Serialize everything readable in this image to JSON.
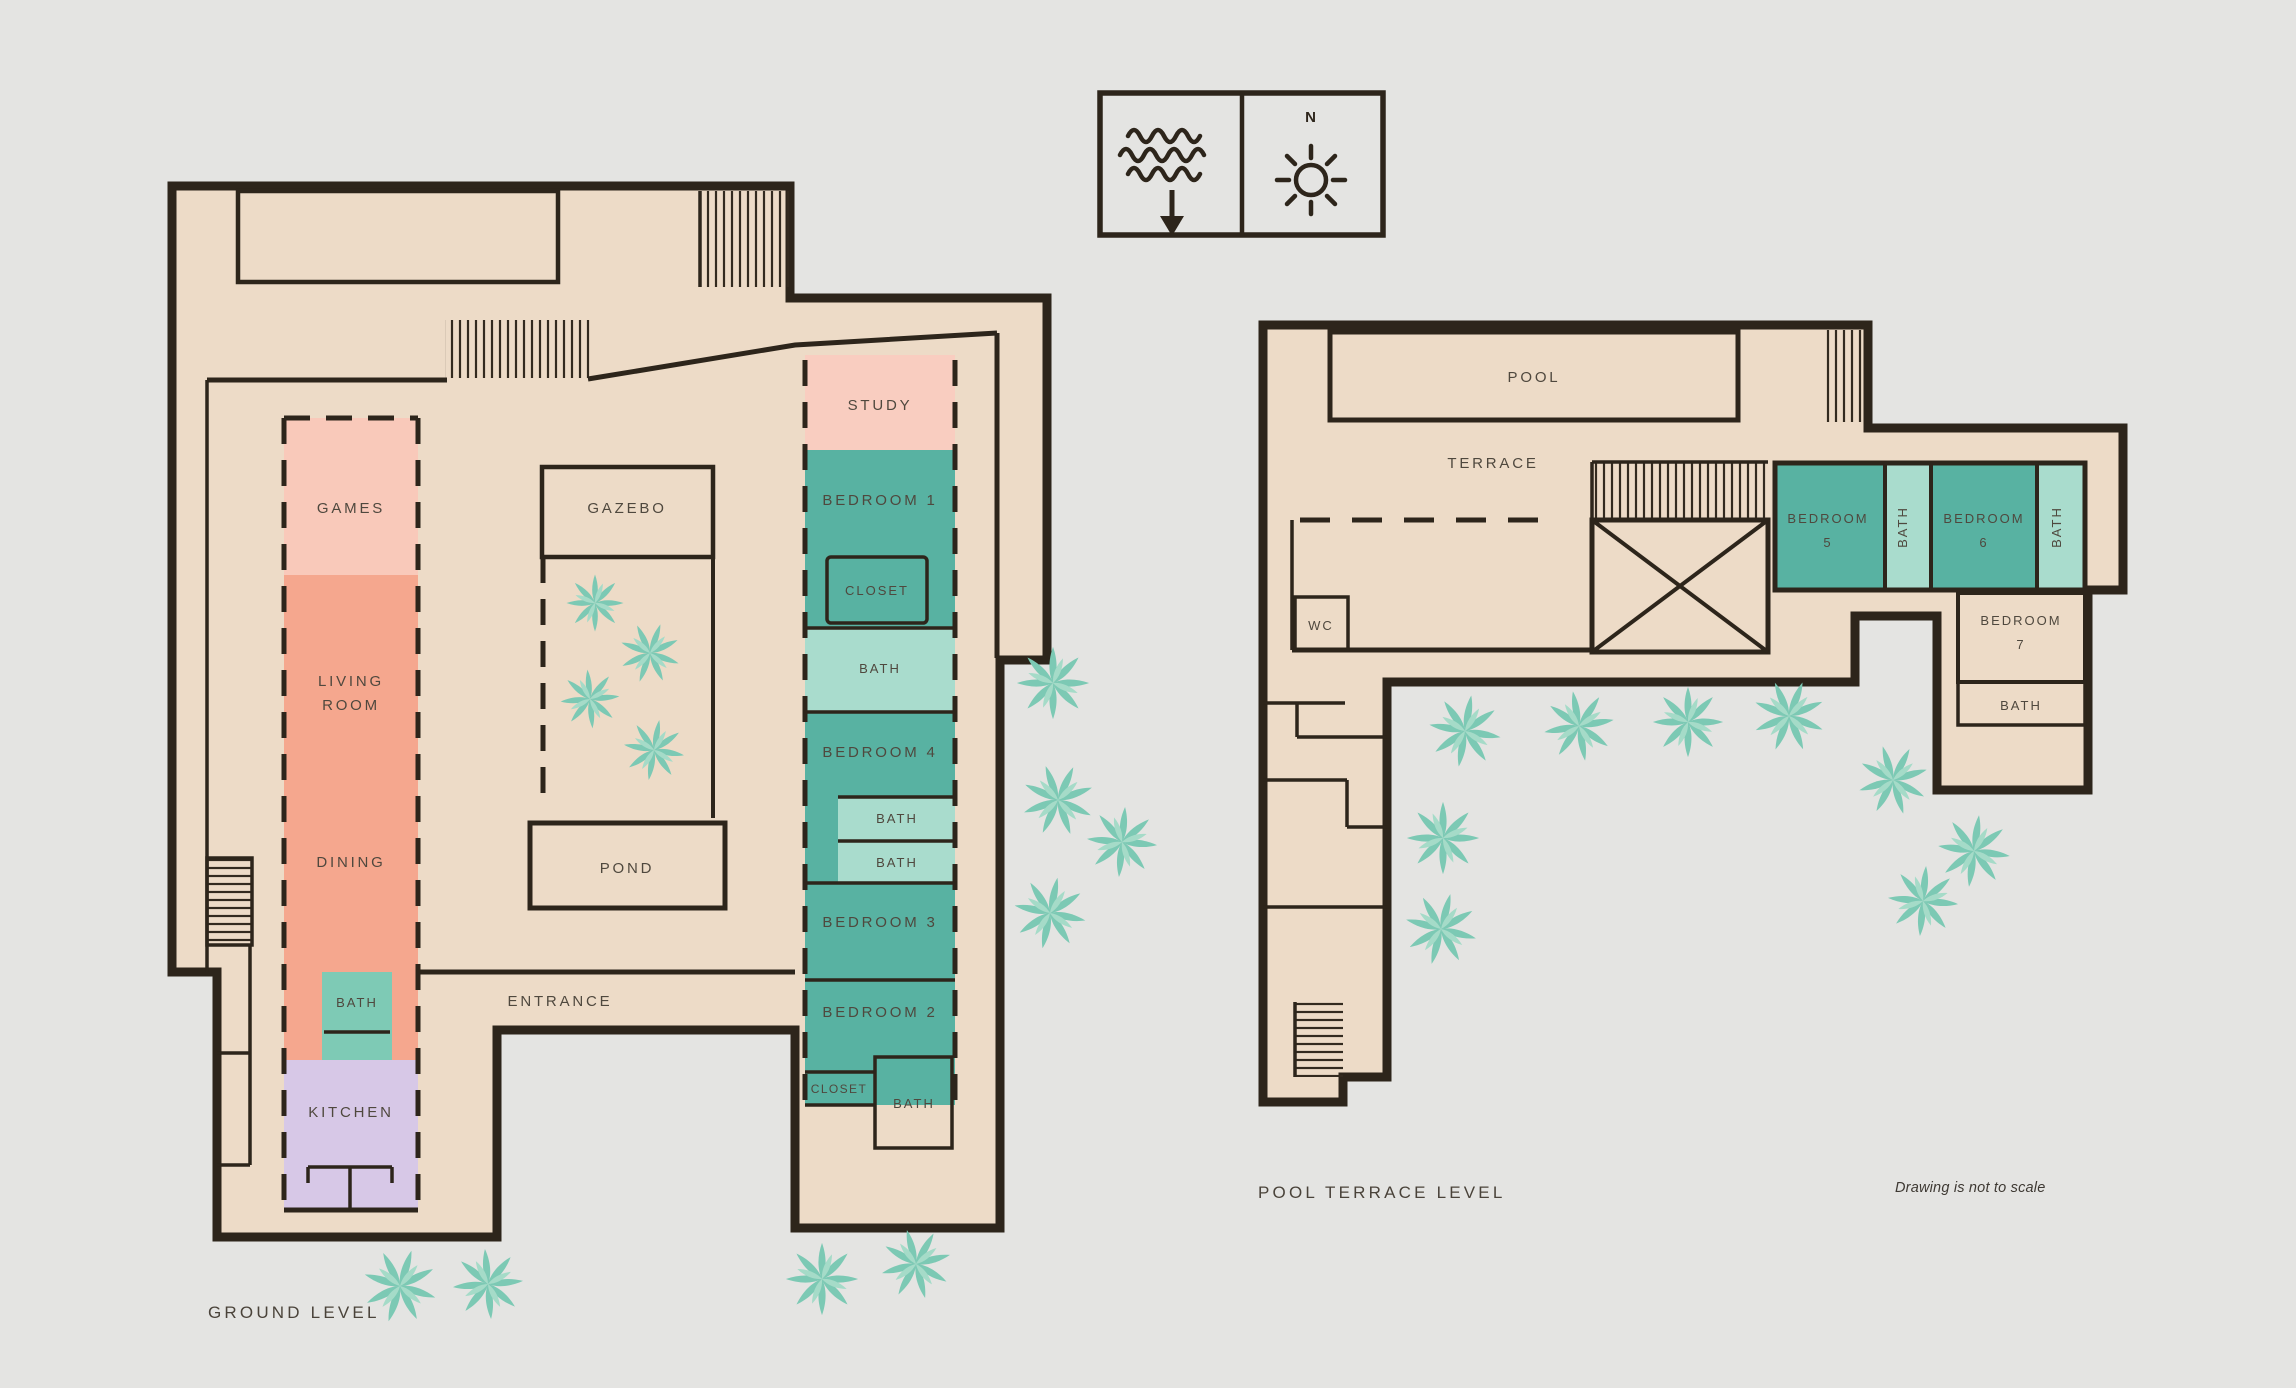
{
  "page": {
    "background": "#e4e4e2",
    "note": "Drawing is not to scale",
    "colors": {
      "floor": "#eddbc7",
      "wall": "#2d251b",
      "label_text": "#4f483e",
      "pink": "#f9c9ba",
      "salmon": "#f5a78e",
      "lavender": "#d7c8e7",
      "teal_bedroom": "#58b2a2",
      "teal_bath_medium": "#7ecab5",
      "teal_bath_light": "#a9dccd",
      "water_blue": "#97dadd",
      "plant": "#7cc9b4",
      "plant_light": "#a5dbc8"
    }
  },
  "legend": {
    "north_label": "N",
    "icons": {
      "waves": "waves-icon",
      "direction": "down-arrow-icon",
      "sun": "sun-icon"
    }
  },
  "ground_level": {
    "title": "GROUND LEVEL",
    "rooms": {
      "games": "GAMES",
      "living_room": [
        "LIVING",
        "ROOM"
      ],
      "dining": "DINING",
      "bath_main": "BATH",
      "kitchen": "KITCHEN",
      "gazebo": "GAZEBO",
      "pond": "POND",
      "entrance": "ENTRANCE",
      "study": "STUDY",
      "bedroom1": "BEDROOM 1",
      "closet1": "CLOSET",
      "bath1": "BATH",
      "bedroom4": "BEDROOM 4",
      "bath4a": "BATH",
      "bath4b": "BATH",
      "bedroom3": "BEDROOM 3",
      "bedroom2": "BEDROOM 2",
      "closet2": "CLOSET",
      "bath2": "BATH"
    }
  },
  "pool_level": {
    "title": "POOL TERRACE LEVEL",
    "rooms": {
      "pool": "POOL",
      "terrace": "TERRACE",
      "wc": "WC",
      "bedroom5": [
        "BEDROOM",
        "5"
      ],
      "bath5": "BATH",
      "bedroom6": [
        "BEDROOM",
        "6"
      ],
      "bath6": "BATH",
      "bedroom7": [
        "BEDROOM",
        "7"
      ],
      "bath7": "BATH"
    }
  }
}
